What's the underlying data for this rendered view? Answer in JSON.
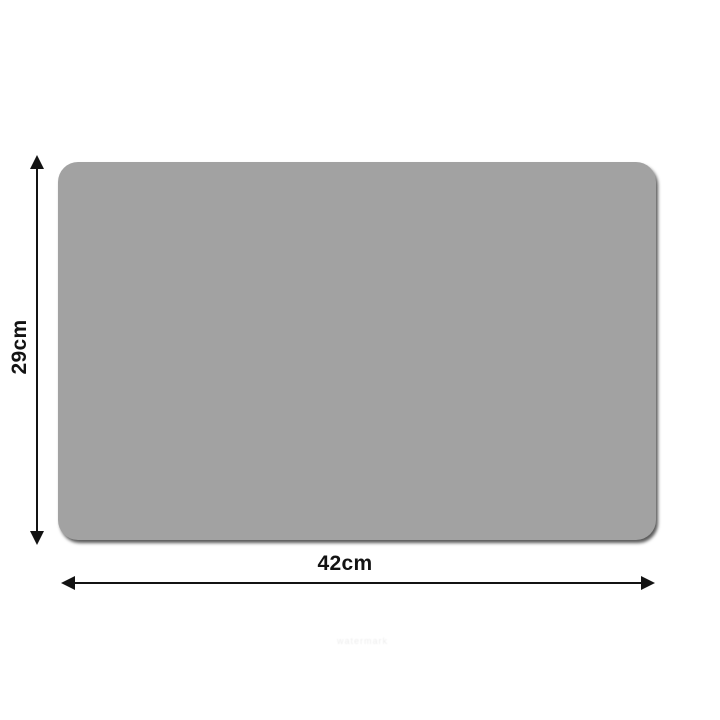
{
  "image": {
    "description": "Dimension diagram of a grey rectangular mat with rounded corners",
    "background_color": "#ffffff"
  },
  "product": {
    "shape": "rounded-rectangle",
    "fill_color": "#a2a2a2",
    "shadow_color": "#5a5a5a",
    "corner_radius_px": 20
  },
  "dimensions": {
    "line_color": "#131313",
    "height": {
      "value": "29cm",
      "orientation": "vertical",
      "label_rotated": true
    },
    "width": {
      "value": "42cm",
      "orientation": "horizontal"
    }
  },
  "watermark": {
    "text": "watermark",
    "color": "#ededed",
    "legible": false
  }
}
